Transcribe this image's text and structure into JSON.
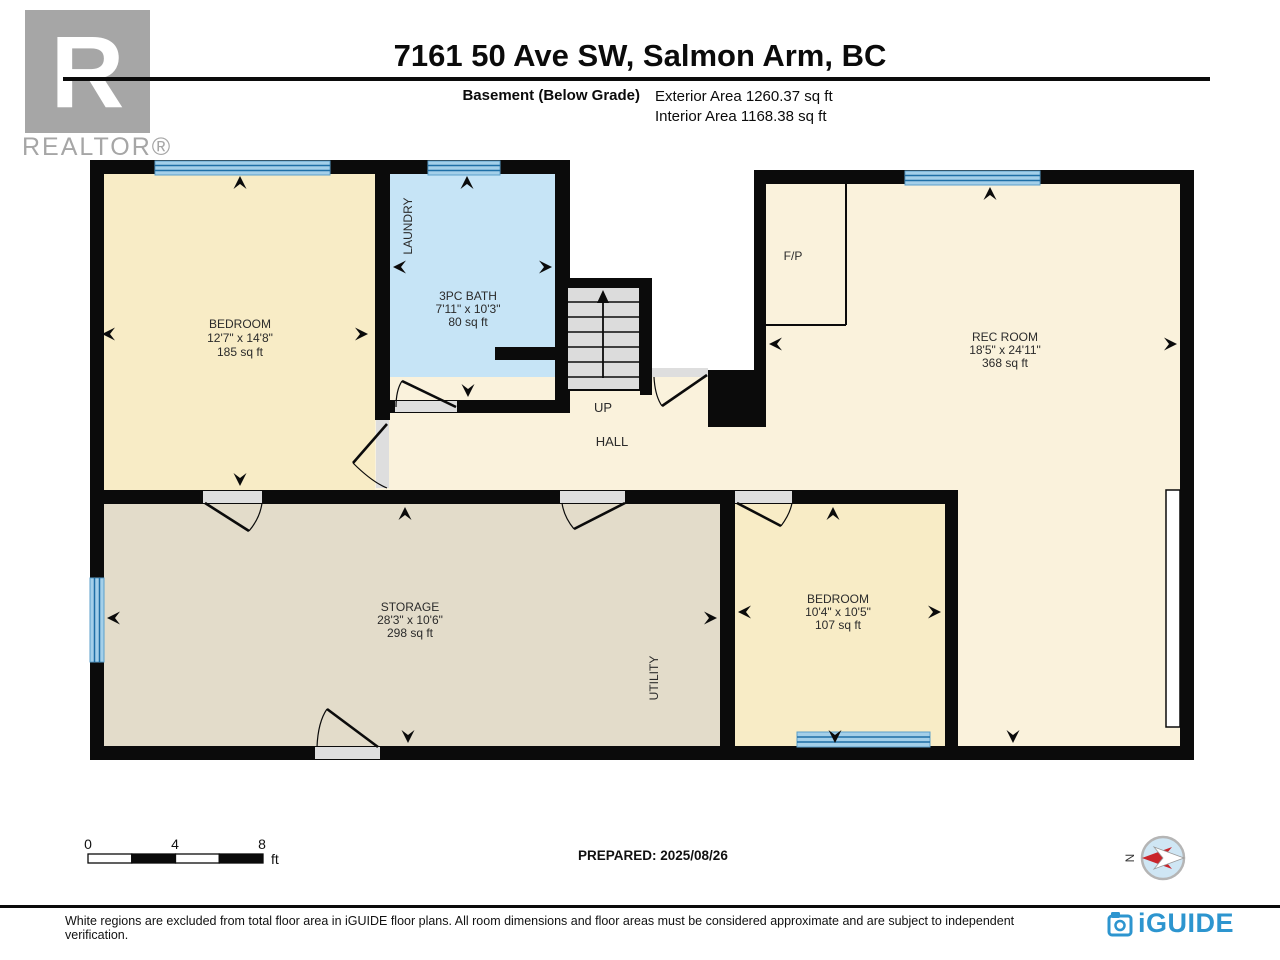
{
  "header": {
    "logo_letter": "R",
    "logo_text": "REALTOR®",
    "title": "7161 50 Ave SW, Salmon Arm, BC",
    "floor_label": "Basement (Below Grade)",
    "exterior_area": "Exterior Area 1260.37 sq ft",
    "interior_area": "Interior Area 1168.38 sq ft"
  },
  "floor_plan": {
    "rooms": [
      {
        "name": "BEDROOM",
        "dimensions": "12'7\" x 14'8\"",
        "area": "185 sq ft"
      },
      {
        "name": "3PC BATH",
        "dimensions": "7'11\" x 10'3\"",
        "area": "80 sq ft"
      },
      {
        "name": "REC ROOM",
        "dimensions": "18'5\" x 24'11\"",
        "area": "368 sq ft"
      },
      {
        "name": "STORAGE",
        "dimensions": "28'3\" x 10'6\"",
        "area": "298 sq ft"
      },
      {
        "name": "BEDROOM",
        "dimensions": "10'4\" x 10'5\"",
        "area": "107 sq ft"
      }
    ],
    "labels": {
      "laundry": "LAUNDRY",
      "utility": "UTILITY",
      "hall": "HALL",
      "up": "UP",
      "fireplace": "F/P"
    },
    "compass_north": "N"
  },
  "scale_bar": {
    "ticks": [
      "0",
      "4",
      "8"
    ],
    "unit": "ft"
  },
  "prepared_label": "PREPARED: 2025/08/26",
  "footer": {
    "disclaimer": "White regions are excluded from total floor area in iGUIDE floor plans. All room dimensions and floor areas must be considered approximate and are subject to independent verification.",
    "brand": "iGUIDE"
  },
  "colors": {
    "wall": "#0b0b0b",
    "bedroom_fill": "#F8ECC6",
    "rec_hall_fill": "#FAF2DC",
    "bath_fill": "#C6E4F6",
    "storage_fill": "#E3DCCA",
    "stairs_fill": "#DCDCDC",
    "window_fill": "#A3CFE9",
    "window_stripe": "#1E6FA6",
    "brand_blue": "#2D95CF",
    "compass_red": "#C9252B",
    "logo_gray": "#A6A6A6"
  }
}
